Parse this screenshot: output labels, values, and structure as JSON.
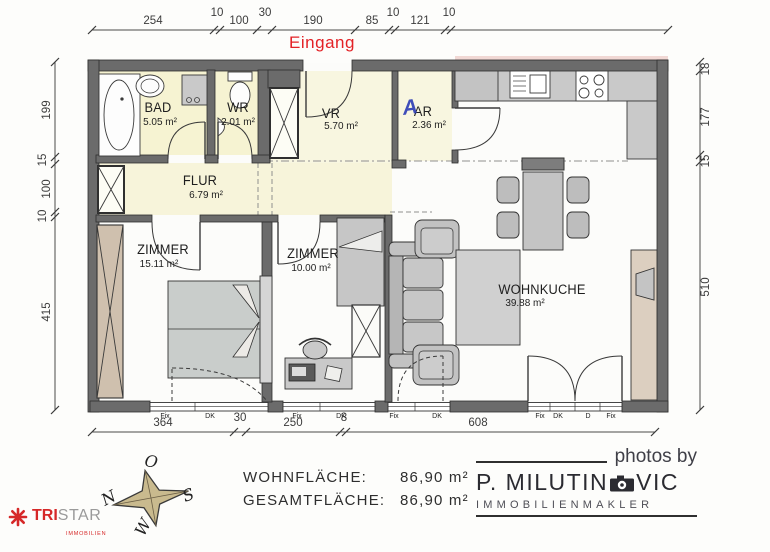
{
  "entrance": {
    "label": "Eingang"
  },
  "annotations": {
    "ar_mark": "A"
  },
  "dimensions": {
    "top": [
      "254",
      "10",
      "100",
      "30",
      "190",
      "85",
      "10",
      "121",
      "10"
    ],
    "left": [
      "199",
      "15",
      "100",
      "10",
      "415"
    ],
    "right": [
      "18",
      "177",
      "15",
      "510"
    ],
    "bottom": [
      "364",
      "30",
      "250",
      "8",
      "608"
    ]
  },
  "rooms": {
    "bad": {
      "name": "BAD",
      "area": "5.05 m²"
    },
    "wr": {
      "name": "WR",
      "area": "2.01 m²"
    },
    "vr": {
      "name": "VR",
      "area": "5.70 m²"
    },
    "ar": {
      "name": "AR",
      "area": "2.36 m²"
    },
    "flur": {
      "name": "FLUR",
      "area": "6.79 m²"
    },
    "zimmer_gross": {
      "name": "ZIMMER",
      "area": "15.11 m²"
    },
    "zimmer_klein": {
      "name": "ZIMMER",
      "area": "10.00 m²"
    },
    "wohnkueche": {
      "name": "WOHNKUCHE",
      "area": "39.88 m²"
    }
  },
  "window_labels": {
    "fix": "Fix",
    "dk": "DK",
    "d": "D"
  },
  "summary": {
    "wohnflaeche_label": "WOHNFLÄCHE:",
    "wohnflaeche_value": "86,90 m²",
    "gesamtflaeche_label": "GESAMTFLÄCHE:",
    "gesamtflaeche_value": "86,90 m²"
  },
  "compass": {
    "east": "O",
    "north": "N",
    "south": "S",
    "west": "W"
  },
  "branding": {
    "tristar": {
      "part1": "TRI",
      "part2": "STAR",
      "subtitle": "IMMOBILIEN"
    },
    "photographer": {
      "tagline": "photos by",
      "name_left": "P. MILUTIN",
      "name_right": "VIC",
      "subtitle": "IMMOBILIENMAKLER"
    }
  },
  "colors": {
    "wall": "#6b6b6b",
    "wet_room_fill": "#f6f3d2",
    "hall_fill": "#f7f4da",
    "accent_red": "#e32226",
    "furniture_gray": "#c4c4c4",
    "wood_tan": "#cfc0ae",
    "compass_star": "#c9ba8e",
    "annotation_blue": "#2b3bb5"
  }
}
